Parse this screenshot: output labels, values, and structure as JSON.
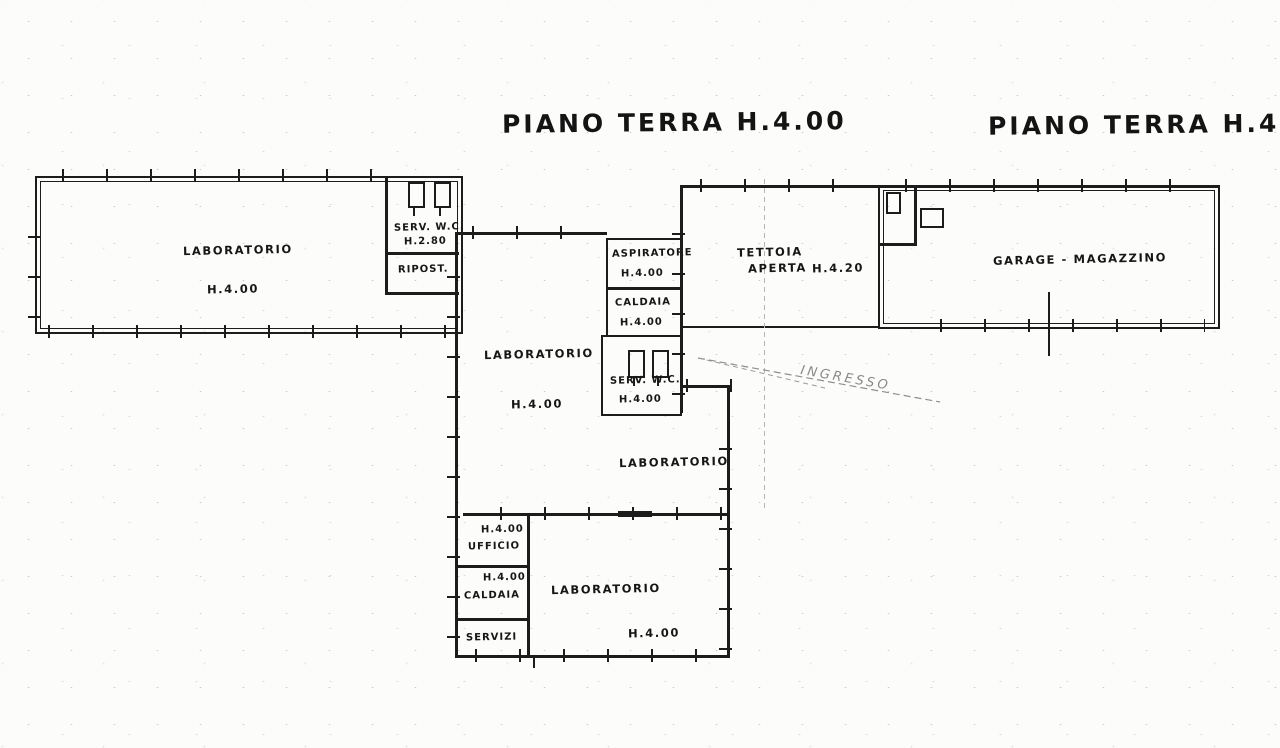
{
  "titles": {
    "left": "PIANO TERRA H.4.00",
    "right": "PIANO TERRA H.4.20"
  },
  "rooms": {
    "lab_left": {
      "name": "LABORATORIO",
      "height": "H.4.00"
    },
    "serv_wc_top": {
      "name": "SERV. W.C.",
      "height": "H.2.80"
    },
    "ripost": {
      "name": "RIPOST."
    },
    "aspiratore": {
      "name": "ASPIRATORE",
      "height": "H.4.00"
    },
    "caldaia_top": {
      "name": "CALDAIA",
      "height": "H.4.00"
    },
    "lab_center": {
      "name": "LABORATORIO",
      "height": "H.4.00"
    },
    "serv_wc_mid": {
      "name": "SERV. W.C.",
      "height": "H.4.00"
    },
    "lab_mid": {
      "name": "LABORATORIO"
    },
    "tettoia": {
      "line1": "TETTOIA",
      "line2": "APERTA",
      "height": "H.4.20"
    },
    "garage": {
      "name": "GARAGE - MAGAZZINO"
    },
    "ingresso": {
      "name": "INGRESSO"
    },
    "ufficio": {
      "name": "UFFICIO",
      "height": "H.4.00"
    },
    "caldaia_bot": {
      "name": "CALDAIA",
      "height": "H.4.00"
    },
    "servizi": {
      "name": "SERVIZI"
    },
    "lab_bottom": {
      "name": "LABORATORIO",
      "height": "H.4.00"
    }
  },
  "colors": {
    "ink": "#1c1c1c",
    "pencil": "#8f8f8f",
    "paper": "#fcfcfa"
  }
}
